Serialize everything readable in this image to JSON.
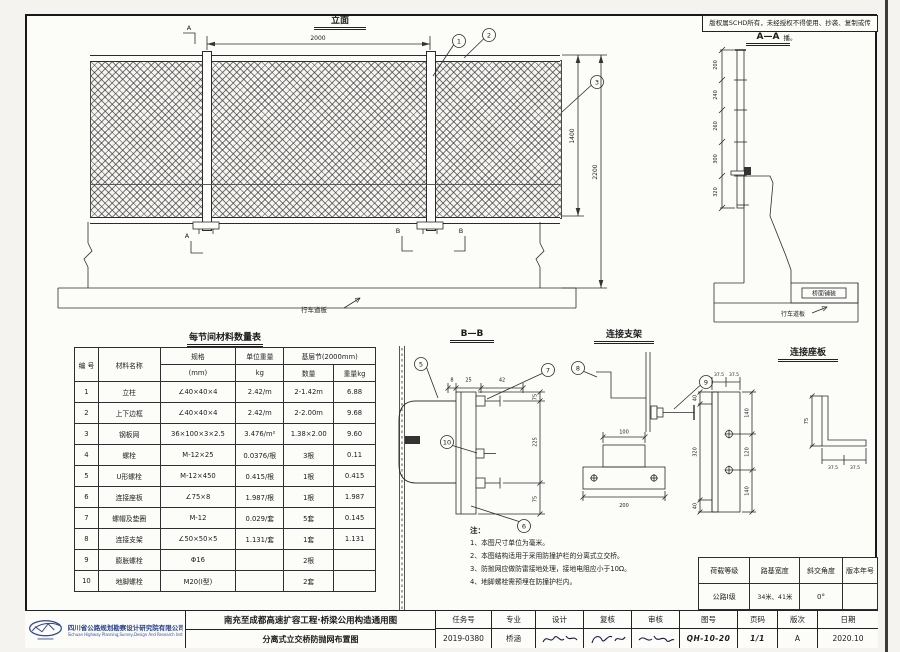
{
  "copyright_notice": "版权属SCHD所有，未经授权不得使用、抄袭、复制或传播。",
  "views": {
    "elevation": {
      "title": "立面",
      "span_dim": "2000",
      "mesh_height_dim": "1400",
      "total_height_dim": "2200",
      "marker_a": "A",
      "marker_b": "B",
      "deck_label": "行车道板"
    },
    "section_aa": {
      "title": "A—A",
      "post_dims": [
        "200",
        "240",
        "260",
        "300",
        "320"
      ],
      "pavement_label": "桥面铺装",
      "deck_label": "行车道板"
    },
    "section_bb": {
      "title": "B—B",
      "top_dims": [
        "8",
        "25",
        "42"
      ],
      "side_dims": [
        "75",
        "225",
        "75"
      ]
    },
    "bracket": {
      "title": "连接支架",
      "top_width_dim": "100",
      "base_width_dim": "200"
    },
    "seat_plate": {
      "title": "连接座板",
      "top_dims": [
        "37.5",
        "37.5"
      ],
      "left_dims": [
        "40",
        "320",
        "40"
      ],
      "right_dims": [
        "140",
        "120",
        "140"
      ],
      "angle_bottom_dims": [
        "37.5",
        "37.5"
      ],
      "angle_leg_dim": "75"
    },
    "callouts": {
      "c1": "1",
      "c2": "2",
      "c3": "3",
      "c5": "5",
      "c6": "6",
      "c7": "7",
      "c8": "8",
      "c9": "9",
      "c10": "10"
    }
  },
  "material_table": {
    "title": "每节间材料数量表",
    "headers": {
      "no": "编 号",
      "name": "材料名称",
      "spec": "规格",
      "spec_unit": "(mm)",
      "unit_weight": "单位重量",
      "unit_weight_unit": "kg",
      "section": "基层节(2000mm)",
      "qty": "数量",
      "weight": "重量kg"
    },
    "rows": [
      {
        "no": "1",
        "name": "立柱",
        "spec": "∠40×40×4",
        "unit": "2.42/m",
        "qty": "2-1.42m",
        "weight": "6.88"
      },
      {
        "no": "2",
        "name": "上下边框",
        "spec": "∠40×40×4",
        "unit": "2.42/m",
        "qty": "2-2.00m",
        "weight": "9.68"
      },
      {
        "no": "3",
        "name": "钢板网",
        "spec": "36×100×3×2.5",
        "unit": "3.476/m²",
        "qty": "1.38×2.00",
        "weight": "9.60"
      },
      {
        "no": "4",
        "name": "螺栓",
        "spec": "M-12×25",
        "unit": "0.0376/根",
        "qty": "3根",
        "weight": "0.11"
      },
      {
        "no": "5",
        "name": "U形螺栓",
        "spec": "M-12×450",
        "unit": "0.415/根",
        "qty": "1根",
        "weight": "0.415"
      },
      {
        "no": "6",
        "name": "连接座板",
        "spec": "∠75×8",
        "unit": "1.987/根",
        "qty": "1根",
        "weight": "1.987"
      },
      {
        "no": "7",
        "name": "螺帽及垫圈",
        "spec": "M-12",
        "unit": "0.029/套",
        "qty": "5套",
        "weight": "0.145"
      },
      {
        "no": "8",
        "name": "连接支架",
        "spec": "∠50×50×5",
        "unit": "1.131/套",
        "qty": "1套",
        "weight": "1.131"
      },
      {
        "no": "9",
        "name": "膨胀螺栓",
        "spec": "Φ16",
        "unit": "",
        "qty": "2根",
        "weight": ""
      },
      {
        "no": "10",
        "name": "地脚螺栓",
        "spec": "M20(Ⅰ型)",
        "unit": "",
        "qty": "2套",
        "weight": ""
      }
    ]
  },
  "notes": {
    "label": "注：",
    "items": [
      "1、本图尺寸单位为毫米。",
      "2、本图结构适用于采用防撞护栏的分离式立交桥。",
      "3、防抛网应做防雷接地处理，接地电阻应小于10Ω。",
      "4、地脚螺栓需预埋在防撞护栏内。"
    ]
  },
  "params_table": {
    "headers": [
      "荷载等级",
      "路基宽度",
      "斜交角度",
      "版本年号"
    ],
    "values": [
      "公路Ⅰ级",
      "34米、41米",
      "0°",
      ""
    ]
  },
  "title_block": {
    "company": "四川省公路规划勘察设计研究院有限公司",
    "company_en": "Sichuan Highway Planning,Survey,Design And Research Institute Ltd",
    "project": "南充至成都高速扩容工程·桥梁公用构造通用图",
    "drawing": "分离式立交桥防抛网布置图",
    "fields": [
      {
        "label": "任务号",
        "value": "2019-0380"
      },
      {
        "label": "专业",
        "value": "桥涵"
      },
      {
        "label": "设计",
        "value": ""
      },
      {
        "label": "复核",
        "value": ""
      },
      {
        "label": "审核",
        "value": ""
      },
      {
        "label": "图号",
        "value": "QH-10-20"
      },
      {
        "label": "页码",
        "value": "1/1"
      },
      {
        "label": "版次",
        "value": "A"
      },
      {
        "label": "日期",
        "value": "2020.10"
      }
    ]
  }
}
